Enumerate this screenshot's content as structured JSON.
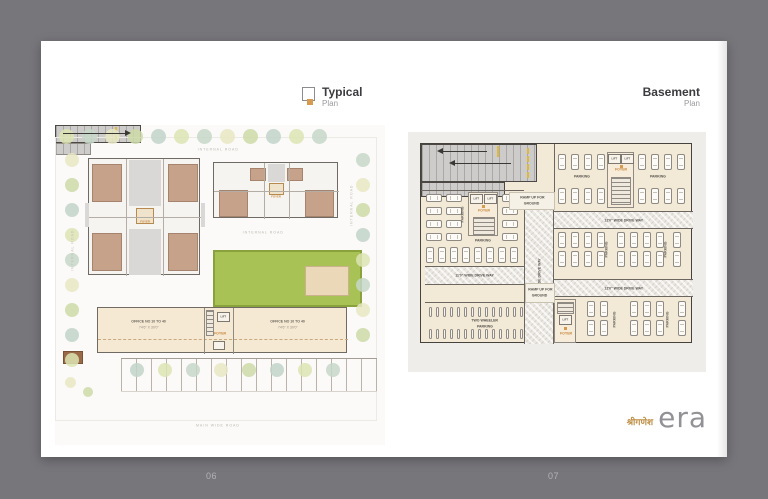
{
  "spread": {
    "left_page": {
      "title": "Typical",
      "subtitle": "Plan",
      "roads": {
        "top": "INTERNAL ROAD",
        "left": "INTERNAL ROAD",
        "middle": "INTERNAL ROAD",
        "right": "INTERNAL ROAD",
        "bottom": "MAIN WIDE ROAD"
      },
      "office_left": {
        "line1": "OFFICE NO 10 TO 40",
        "line2": "74'6\" X 30'0\""
      },
      "office_right": {
        "line1": "OFFICE NO 10 TO 40",
        "line2": "74'6\" X 30'0\""
      },
      "lift": "LIFT",
      "foyer": "FOYER"
    },
    "right_page": {
      "title": "Basement",
      "subtitle": "Plan",
      "lift": "LIFT",
      "foyer": "FOYER",
      "parking": "PARKING",
      "ramp": {
        "line1": "RAMP UP FOR",
        "line2": "GROUND"
      },
      "driveway_12": "12'0\" WIDE DRIVE WAY",
      "driveway_11": "11'0\" WIDE DRIVE WAY",
      "two_wheeler": {
        "line1": "TWO WHEELER",
        "line2": "PARKING"
      }
    },
    "brand": {
      "devanagari": "श्रीगणेश",
      "name": "era"
    }
  },
  "footer": {
    "left_page_number": "06",
    "right_page_number": "07"
  },
  "colors": {
    "background": "#77767b",
    "page": "#ffffff",
    "accent_orange": "#d89a4e",
    "lawn_green": "#a9c256",
    "brand_gold": "#bf8f46",
    "brand_gray": "#929196"
  }
}
